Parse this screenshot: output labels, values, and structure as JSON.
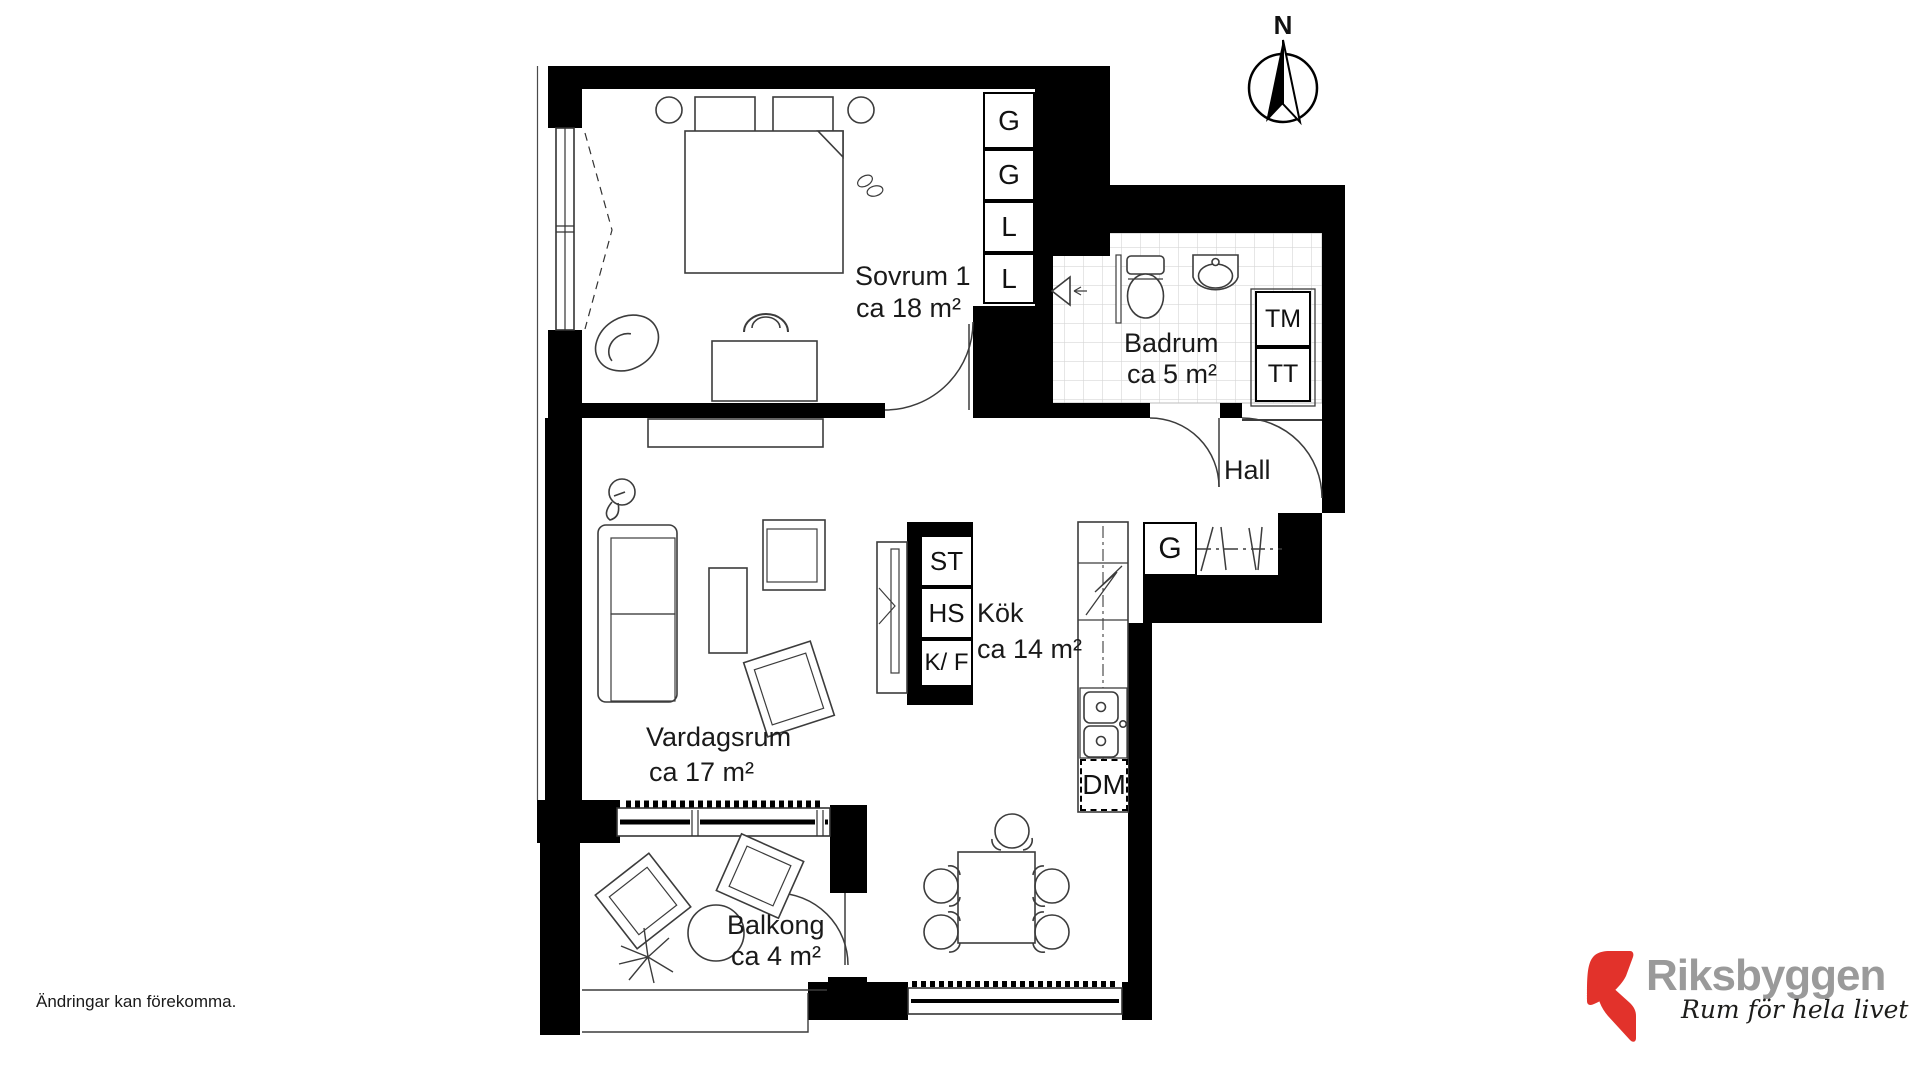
{
  "document_type": "apartment floor plan",
  "compass": {
    "label": "N"
  },
  "rooms": {
    "sovrum": {
      "name": "Sovrum 1",
      "area": "ca 18 m²"
    },
    "badrum": {
      "name": "Badrum",
      "area": "ca 5 m²"
    },
    "hall": {
      "name": "Hall"
    },
    "kok": {
      "name": "Kök",
      "area": "ca 14 m²"
    },
    "vardagsrum": {
      "name": "Vardagsrum",
      "area": "ca 17 m²"
    },
    "balkong": {
      "name": "Balkong",
      "area": "ca 4 m²"
    }
  },
  "fixtures": {
    "bedroom_closets": [
      "G",
      "G",
      "L",
      "L"
    ],
    "bathroom_units": [
      "TM",
      "TT"
    ],
    "hall_closet": "G",
    "kitchen_units": [
      "ST",
      "HS",
      "K/ F"
    ],
    "dishwasher_label": "DM"
  },
  "footer": {
    "disclaimer": "Ändringar kan förekomma."
  },
  "logo": {
    "brand": "Riksbyggen",
    "tagline": "Rum för hela livet",
    "mark_color": "#e2322b",
    "brand_color": "#9a9a9a",
    "tagline_color": "#1d1d1b"
  }
}
